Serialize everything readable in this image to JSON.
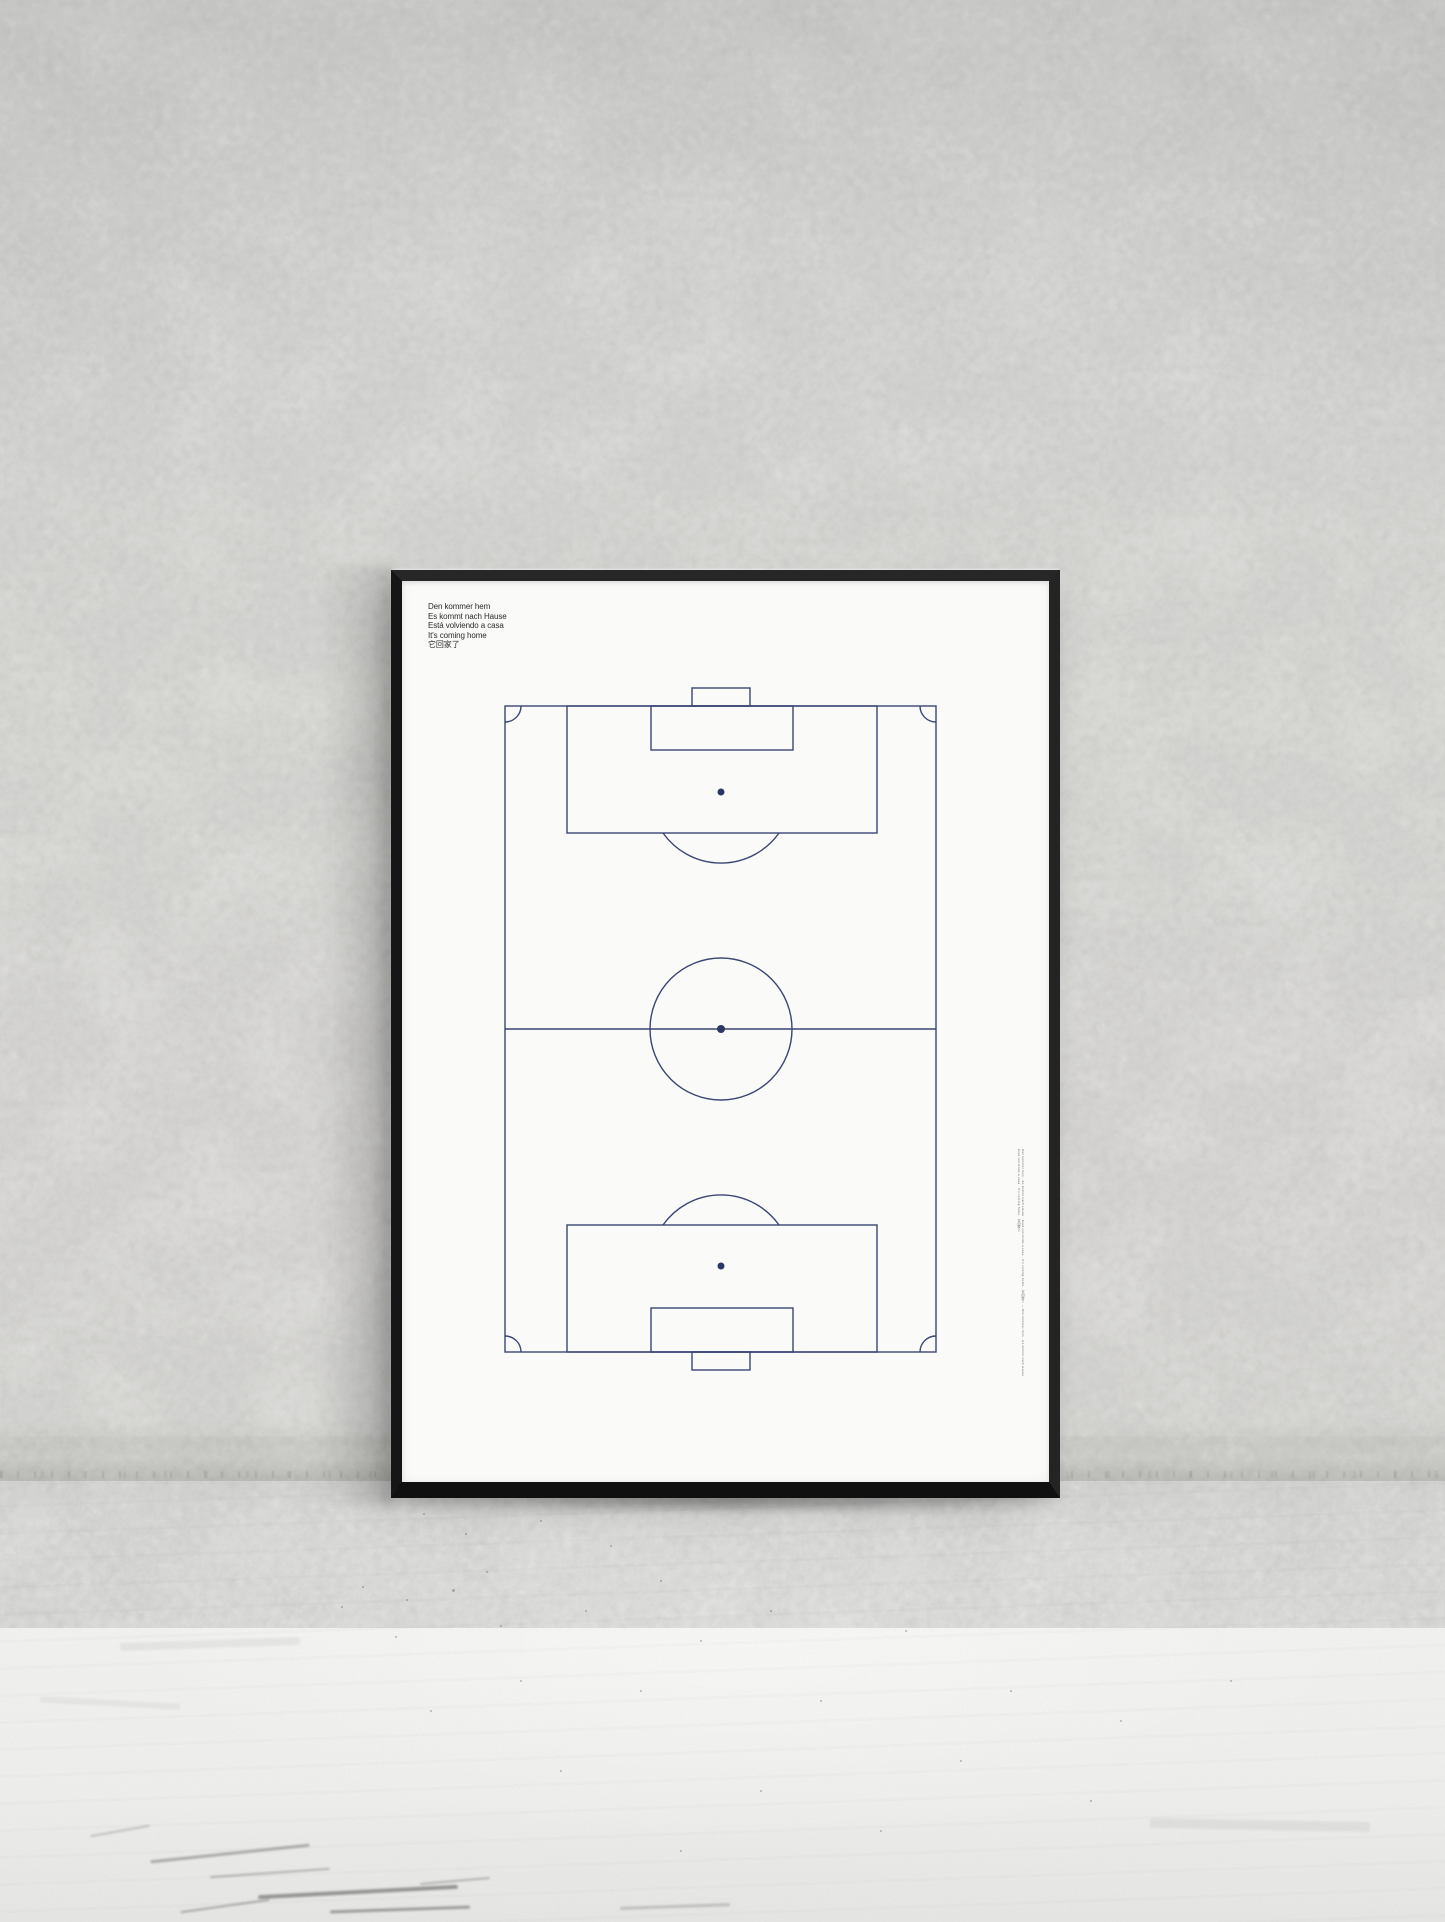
{
  "poster": {
    "motto_lines": [
      "Den kommer hem",
      "Es kommt nach Hause",
      "Está volviendo a casa",
      "It's coming home",
      "它回家了"
    ],
    "vertical_fine_print": "Den kommer hem · Es kommt nach Hause · Está volviendo a casa · It's coming home · 它回家了 — Den kommer hem · Es kommt nach Hause · Está volviendo a casa · It's coming home · 它回家了"
  },
  "colors": {
    "pitch-line": "#3a4573",
    "pitch-dot": "#2c3766",
    "ink": "#2a2a2a",
    "paper": "#fafaf9",
    "frame": "#1c1c1c",
    "wall": "#eaeae8",
    "floor": "#f2f2f0"
  }
}
